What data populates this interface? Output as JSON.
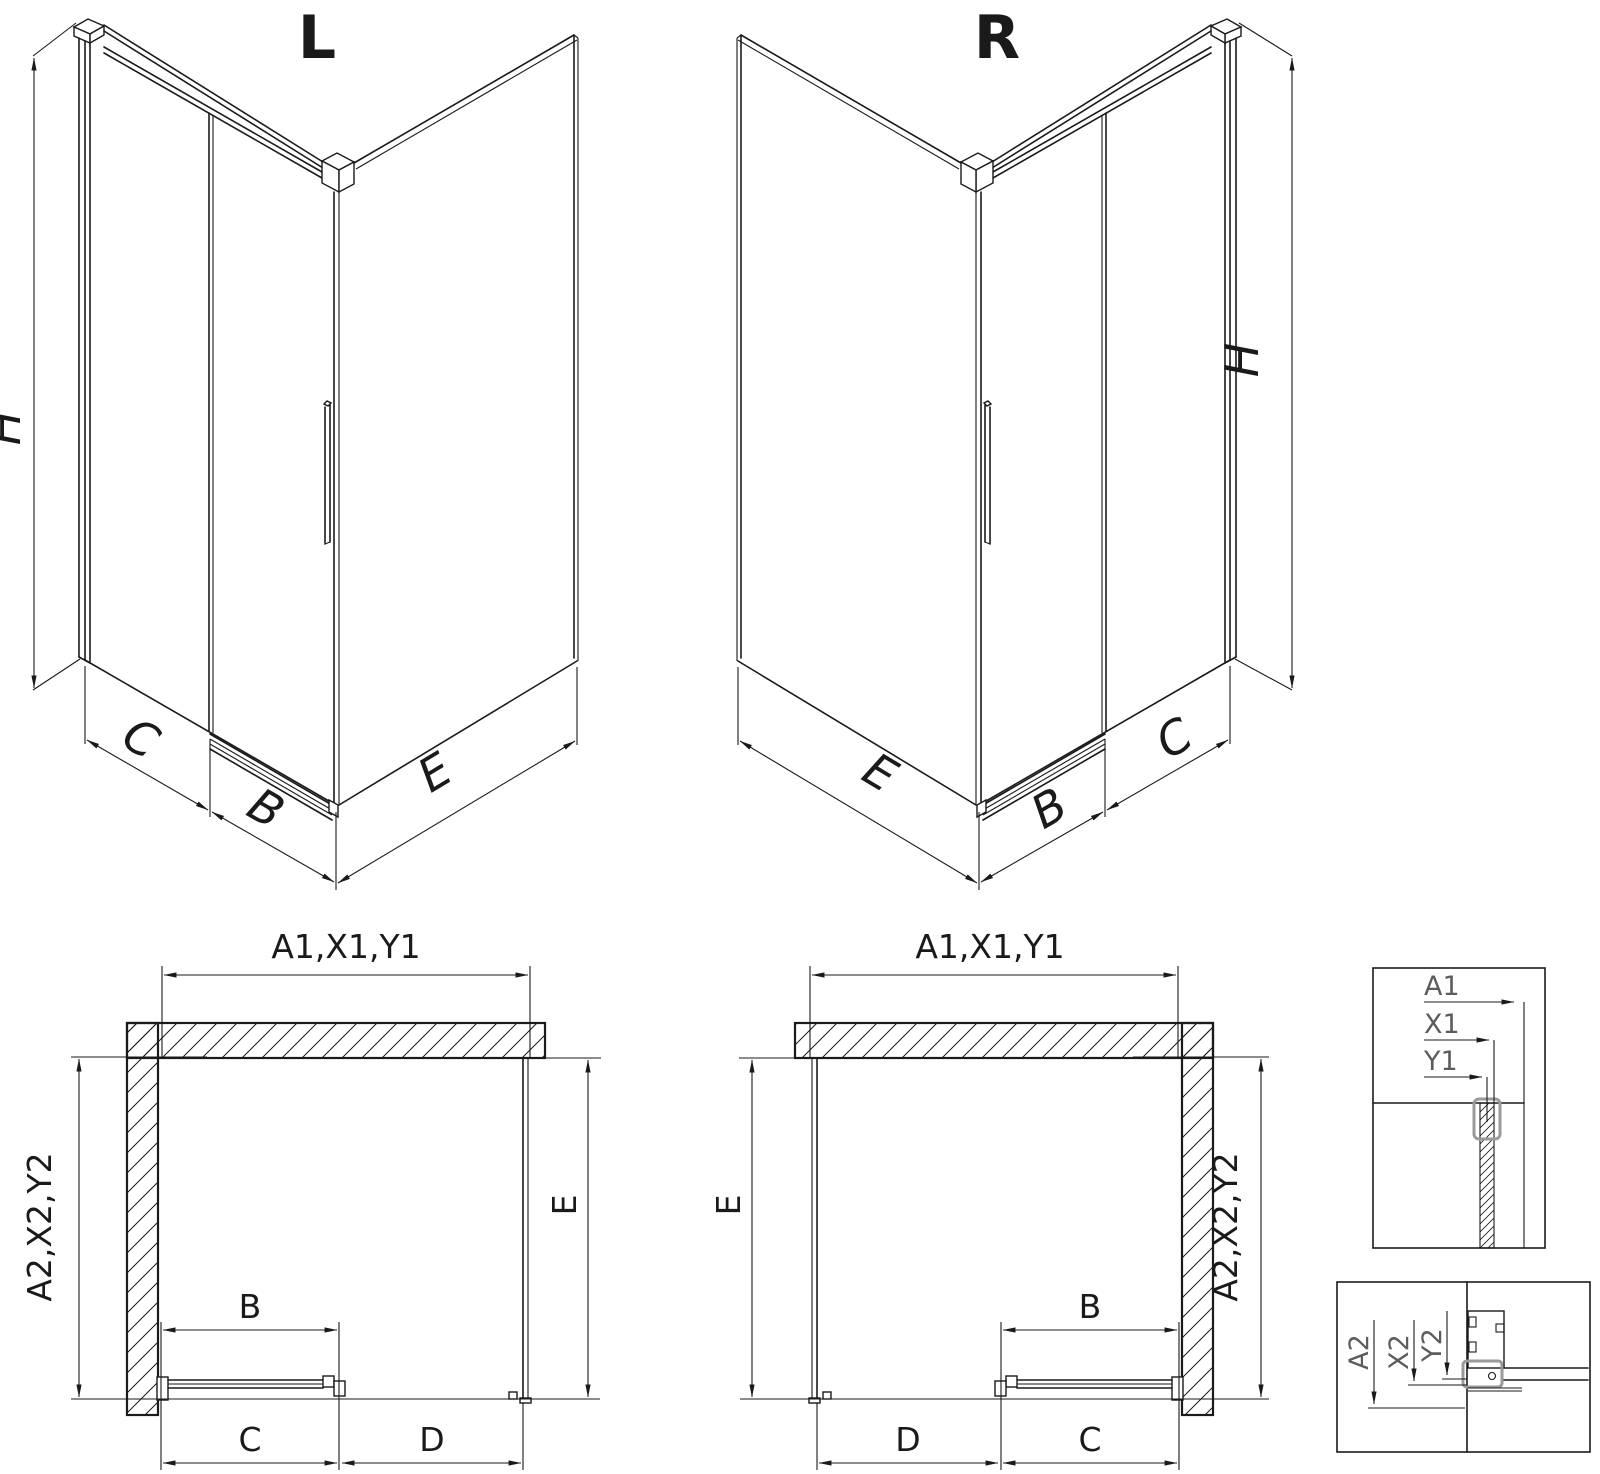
{
  "iso_left": {
    "title": "L",
    "height_label": "H",
    "segment_c": "C",
    "segment_b": "B",
    "segment_e": "E"
  },
  "iso_right": {
    "title": "R",
    "height_label": "H",
    "segment_c": "C",
    "segment_b": "B",
    "segment_e": "E"
  },
  "plan_left": {
    "width_label": "A1,X1,Y1",
    "depth_label": "A2,X2,Y2",
    "door_label": "B",
    "c_label": "C",
    "d_label": "D",
    "e_label": "E"
  },
  "plan_right": {
    "width_label": "A1,X1,Y1",
    "depth_label": "A2,X2,Y2",
    "door_label": "B",
    "c_label": "C",
    "d_label": "D",
    "e_label": "E"
  },
  "detail_top": {
    "a1": "A1",
    "x1": "X1",
    "y1": "Y1"
  },
  "detail_bottom": {
    "a2": "A2",
    "x2": "X2",
    "y2": "Y2"
  },
  "colors": {
    "line": "#1a1a1a",
    "detail_text": "#5c5c5c",
    "highlight": "#9a9a9a",
    "background": "#ffffff"
  }
}
